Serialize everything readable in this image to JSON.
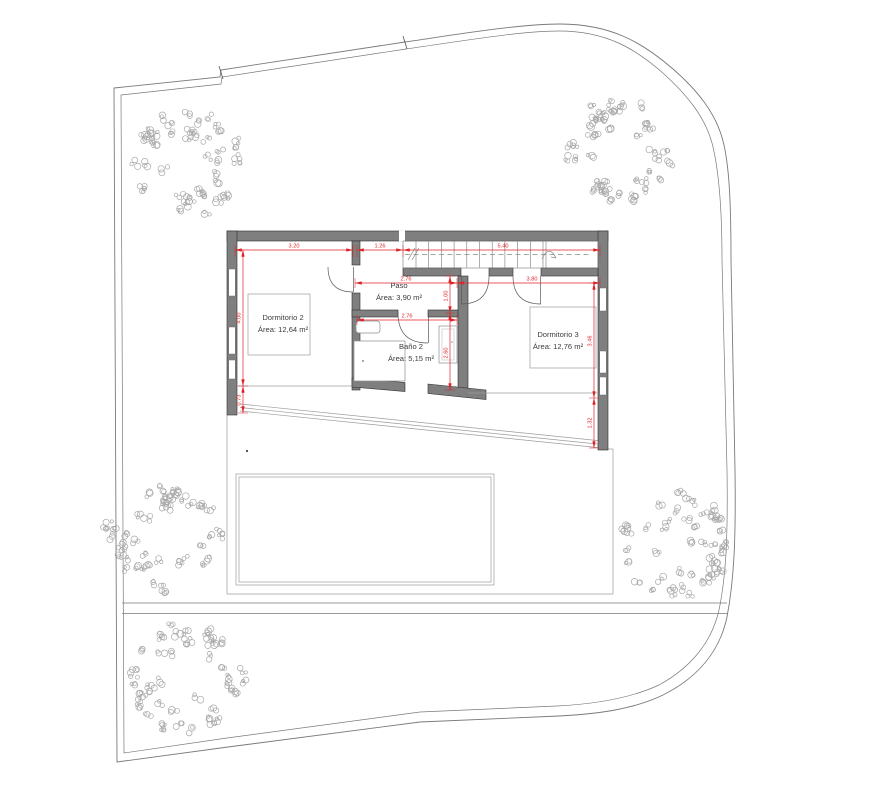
{
  "rooms": [
    {
      "name": "Dormitorio 2",
      "area": "Área: 12,64 m²"
    },
    {
      "name": "Paso",
      "area": "Área: 3,90 m²"
    },
    {
      "name": "Baño 2",
      "area": "Área: 5,15 m²"
    },
    {
      "name": "Dormitorio 3",
      "area": "Área: 12,76 m²"
    }
  ],
  "dims": {
    "top": [
      "3.20",
      "1.26",
      "5.40"
    ],
    "middle": [
      "2.76",
      "3.80"
    ],
    "bano_width": "2.76",
    "left": [
      "4.00",
      "0.73"
    ],
    "paso_height": "1.00",
    "bano_height": "2.60",
    "right": [
      "3.46",
      "1.32"
    ]
  },
  "colors": {
    "dimension_red": "#e02227",
    "wall_gray": "#7f7f7f",
    "wall_edge": "#2f2f2f",
    "line_gray": "#9c9c9c",
    "boundary_gray": "#7a7a7a",
    "tree_gray": "#a8a8a8",
    "label_gray": "#3d3d3d"
  }
}
